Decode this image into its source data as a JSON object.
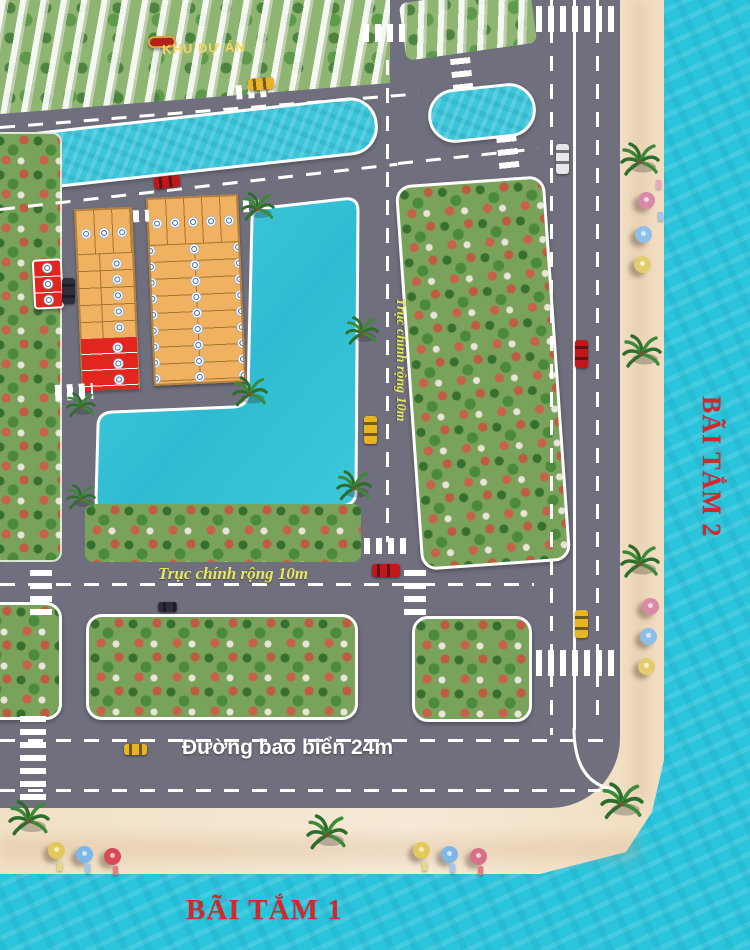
{
  "banner": {
    "label": "KHU DỰ ÁN"
  },
  "roads": {
    "coastal_road": "Đường bao biển 24m",
    "main_axis_horizontal": "Trục chính rộng 10m",
    "main_axis_vertical": "Trục chính rộng 10m"
  },
  "beaches": {
    "beach_1": "BÃI TẮM 1",
    "beach_2": "BÃI TẮM 2"
  },
  "colors": {
    "road_gray": "#6F6F7D",
    "canal_water": "#3CC6DA",
    "sea": "#2AC4DC",
    "sand": "#F4E4CE",
    "lot_orange": "#F0B261",
    "lot_red": "#E2251F",
    "villa_green": "#79A25B",
    "banner_red": "#B2201F",
    "banner_gold": "#F6D65C",
    "label_yellow": "#E7E95C",
    "beach_label_red": "#D5262B",
    "marking_white": "#FFFFFF"
  }
}
